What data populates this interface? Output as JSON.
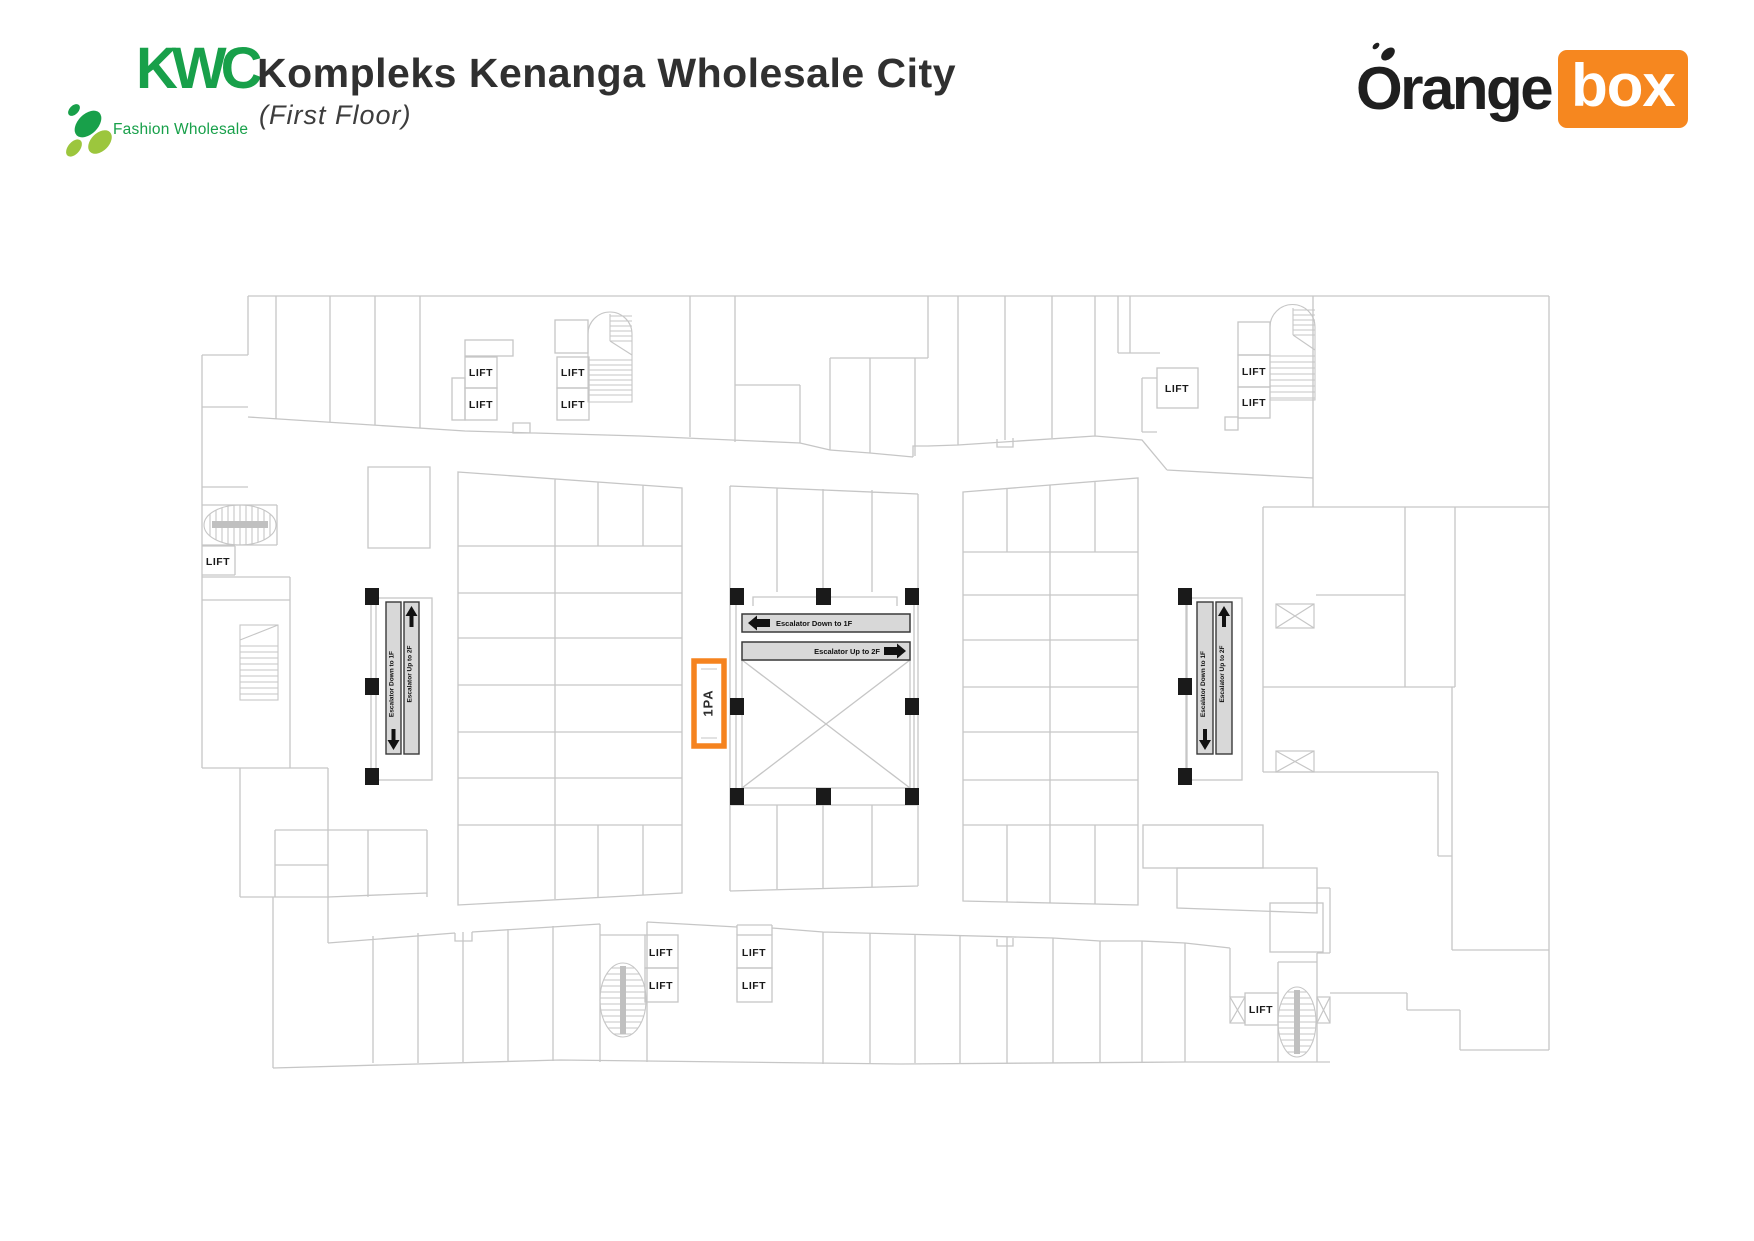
{
  "header": {
    "kwc_logo": {
      "acronym": "KWC",
      "tagline": "Fashion Wholesale"
    },
    "title": "Kompleks Kenanga Wholesale City",
    "subtitle": "(First Floor)",
    "orangebox_logo": {
      "part1": "Orange",
      "part2": "box"
    }
  },
  "floorplan": {
    "highlighted_unit": {
      "label": "1PA"
    },
    "lifts": [
      "LIFT",
      "LIFT",
      "LIFT",
      "LIFT",
      "LIFT",
      "LIFT",
      "LIFT",
      "LIFT",
      "LIFT",
      "LIFT",
      "LIFT",
      "LIFT",
      "LIFT"
    ],
    "escalator_labels": {
      "down": "Escalator Down to 1F",
      "up": "Escalator Up to 2F"
    },
    "colors": {
      "accent_orange": "#F5831F",
      "wall_gray": "#C6C6C6",
      "escalator_fill": "#D8D8D8",
      "column_black": "#1A1A1A",
      "logo_green_dark": "#18A04A",
      "logo_green_light": "#9CC63D"
    }
  }
}
